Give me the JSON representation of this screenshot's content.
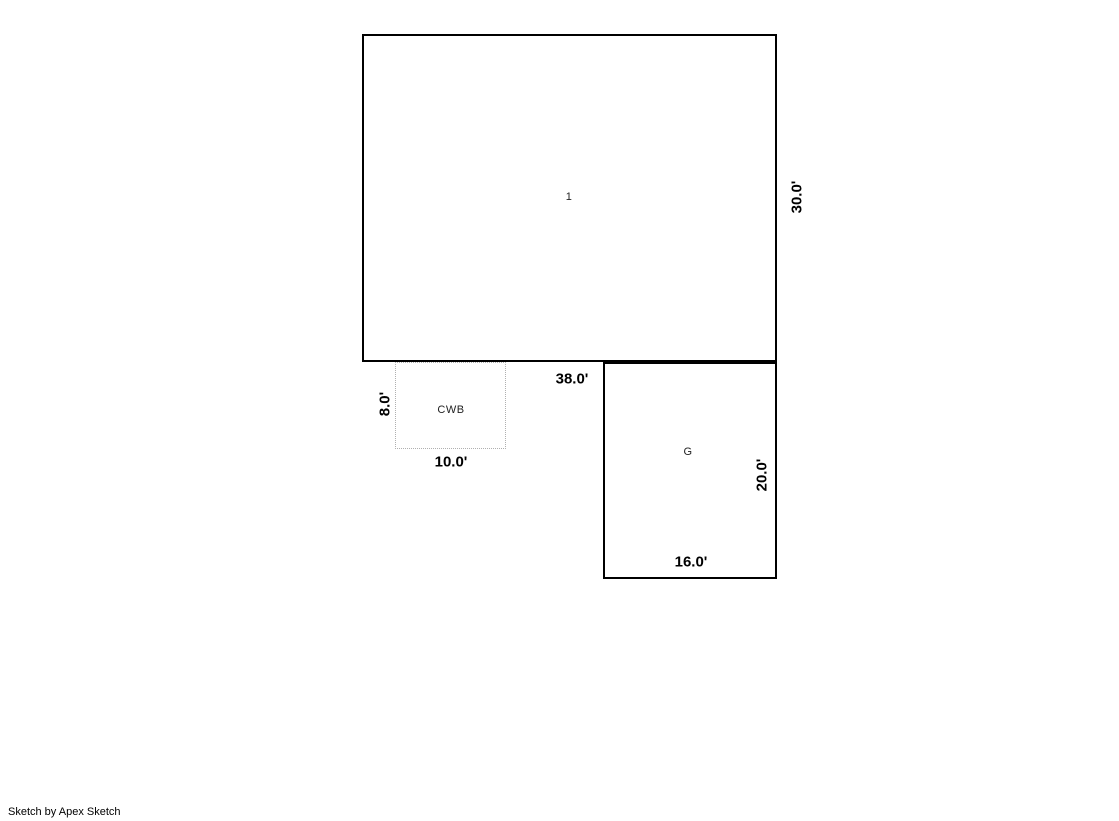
{
  "page": {
    "background": "#ffffff"
  },
  "sketch": {
    "areas": [
      {
        "key": "area-1",
        "label": "1",
        "width_ft": "38.0'",
        "height_ft": "30.0'",
        "border_style": "solid"
      },
      {
        "key": "cwb",
        "label": "CWB",
        "width_ft": "10.0'",
        "height_ft": "8.0'",
        "border_style": "dotted"
      },
      {
        "key": "garage",
        "label": "G",
        "width_ft": "16.0'",
        "height_ft": "20.0'",
        "border_style": "solid"
      }
    ],
    "colors": {
      "line": "#000000",
      "dotted_line": "#b0b0b0",
      "label_text": "#222222",
      "dimension_text": "#000000"
    }
  },
  "footer": {
    "credit": "Sketch by Apex Sketch"
  }
}
